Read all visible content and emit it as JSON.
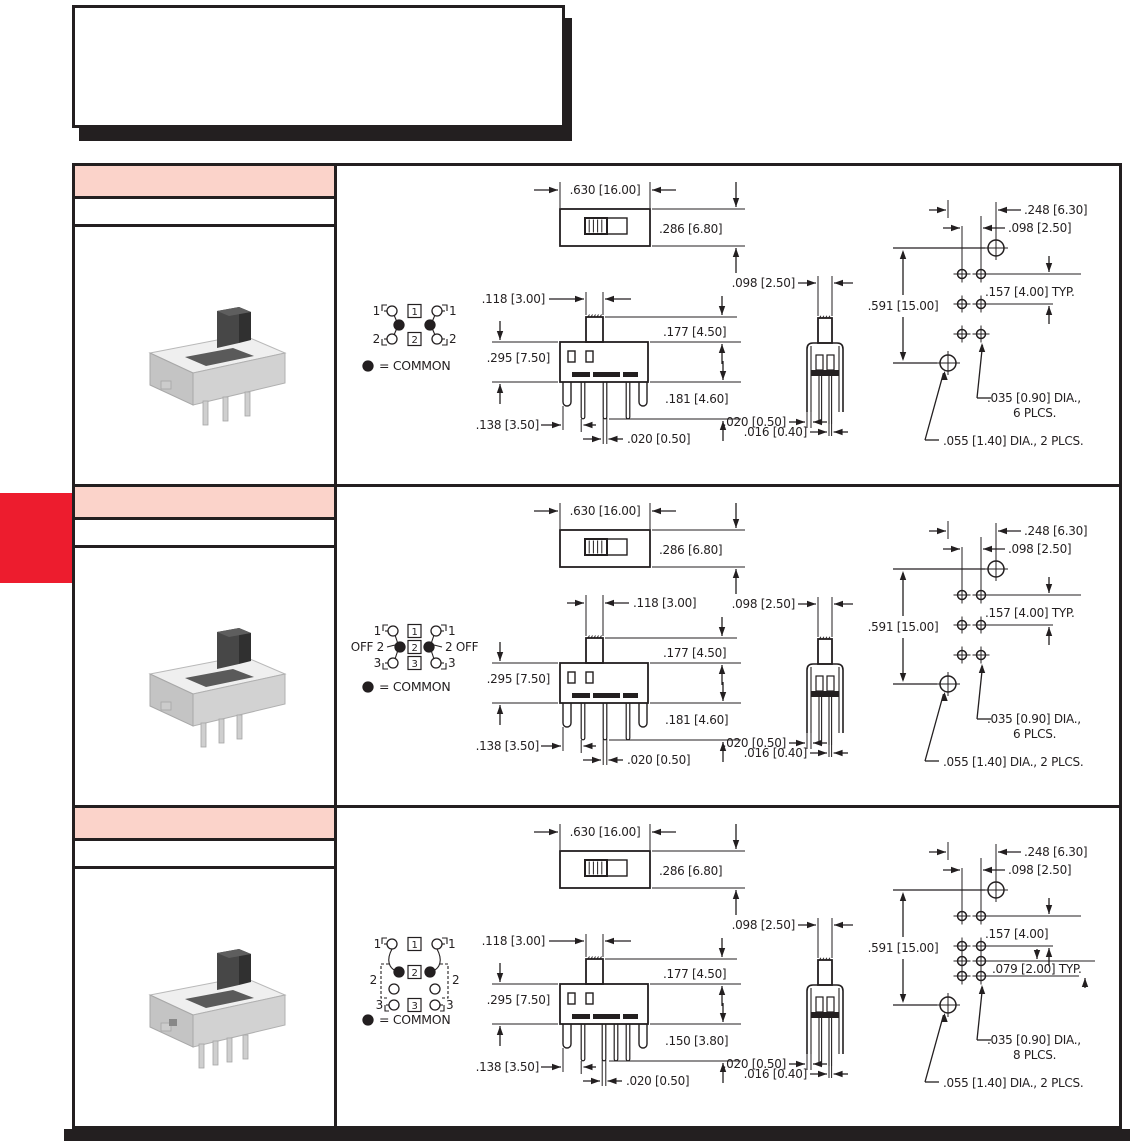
{
  "page": {
    "background": "#ffffff",
    "accent_red": "#ed1c2e",
    "header_pink": "#fbd3ca",
    "line_color": "#231f20"
  },
  "intro_box": {
    "text": ""
  },
  "rows": [
    {
      "id": "row-1",
      "header_text": "",
      "subheader_text": "",
      "schematic": {
        "type": "2-position",
        "left_labels": [
          "1",
          "2"
        ],
        "right_labels": [
          "1",
          "2"
        ],
        "box_numbers": [
          "1",
          "2"
        ],
        "legend": "=  COMMON"
      },
      "top_view": {
        "width": ".630 [16.00]",
        "height": ".286 [6.80]"
      },
      "front_view": {
        "actuator_width": ".118 [3.00]",
        "actuator_height": ".177 [4.50]",
        "body_height": ".295 [7.50]",
        "pin_length": ".181 [4.60]",
        "pin_offset": ".138 [3.50]",
        "pin_width": ".020 [0.50]"
      },
      "end_view": {
        "width": ".098 [2.50]",
        "leg_width": ".020 [0.50]",
        "pin_width": ".016 [0.40]"
      },
      "pcb": {
        "offset_x": ".248 [6.30]",
        "pitch_x": ".098 [2.50]",
        "pitch_y": ".157 [4.00] TYP.",
        "height": ".591 [15.00]",
        "small_hole_line1": ".035 [0.90] DIA.,",
        "small_hole_line2": "6 PLCS.",
        "big_hole": ".055 [1.40] DIA., 2 PLCS.",
        "small_hole_count": 6,
        "big_hole_count": 2
      }
    },
    {
      "id": "row-2",
      "header_text": "",
      "subheader_text": "",
      "schematic": {
        "type": "3-position",
        "left_labels": [
          "1",
          "OFF 2",
          "3"
        ],
        "right_labels": [
          "1",
          "2 OFF",
          "3"
        ],
        "box_numbers": [
          "1",
          "2",
          "3"
        ],
        "legend": "=  COMMON"
      },
      "top_view": {
        "width": ".630 [16.00]",
        "height": ".286 [6.80]"
      },
      "front_view": {
        "actuator_width": ".118 [3.00]",
        "actuator_height": ".177 [4.50]",
        "body_height": ".295 [7.50]",
        "pin_length": ".181 [4.60]",
        "pin_offset": ".138 [3.50]",
        "pin_width": ".020 [0.50]"
      },
      "end_view": {
        "width": ".098 [2.50]",
        "leg_width": ".020 [0.50]",
        "pin_width": ".016 [0.40]"
      },
      "pcb": {
        "offset_x": ".248 [6.30]",
        "pitch_x": ".098 [2.50]",
        "pitch_y": ".157 [4.00] TYP.",
        "height": ".591 [15.00]",
        "small_hole_line1": ".035 [0.90] DIA.,",
        "small_hole_line2": "6 PLCS.",
        "big_hole": ".055 [1.40] DIA., 2 PLCS.",
        "small_hole_count": 6,
        "big_hole_count": 2
      }
    },
    {
      "id": "row-3",
      "header_text": "",
      "subheader_text": "",
      "schematic": {
        "type": "3-position-4-row",
        "left_labels": [
          "1",
          "2",
          "3"
        ],
        "right_labels": [
          "1",
          "2",
          "3"
        ],
        "box_numbers": [
          "1",
          "2",
          "3"
        ],
        "legend": "=  COMMON"
      },
      "top_view": {
        "width": ".630 [16.00]",
        "height": ".286 [6.80]"
      },
      "front_view": {
        "actuator_width": ".118 [3.00]",
        "actuator_height": ".177 [4.50]",
        "body_height": ".295 [7.50]",
        "pin_length": ".150 [3.80]",
        "pin_offset": ".138 [3.50]",
        "pin_width": ".020 [0.50]"
      },
      "end_view": {
        "width": ".098 [2.50]",
        "leg_width": ".020 [0.50]",
        "pin_width": ".016 [0.40]"
      },
      "pcb": {
        "offset_x": ".248 [6.30]",
        "pitch_x": ".098 [2.50]",
        "pitch_y": ".157 [4.00]",
        "pitch_y2": ".079 [2.00] TYP.",
        "height": ".591 [15.00]",
        "small_hole_line1": ".035 [0.90] DIA.,",
        "small_hole_line2": "8 PLCS.",
        "big_hole": ".055 [1.40] DIA., 2 PLCS.",
        "small_hole_count": 8,
        "big_hole_count": 2
      }
    }
  ]
}
